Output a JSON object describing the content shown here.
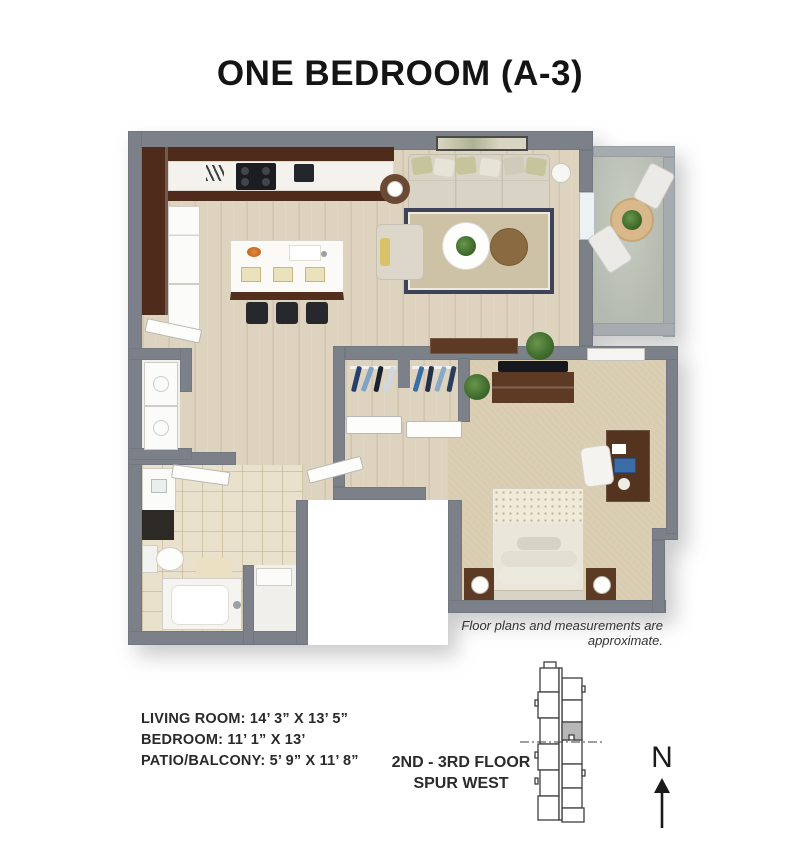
{
  "header": {
    "title": "ONE BEDROOM (A-3)"
  },
  "plan": {
    "disclaimer": "Floor plans and measurements are approximate.",
    "rooms": [
      "kitchen",
      "living room",
      "patio/balcony",
      "bedroom",
      "walk-in closet",
      "bathroom",
      "laundry",
      "hall"
    ]
  },
  "specs": {
    "lines": [
      "LIVING ROOM: 14’ 3” X 13’ 5”",
      "BEDROOM: 11’ 1” X 13’",
      "PATIO/BALCONY: 5’ 9” X 11’ 8”"
    ]
  },
  "location": {
    "line1": "2ND - 3RD FLOOR",
    "line2": "SPUR WEST"
  },
  "compass": {
    "label": "N"
  },
  "colors": {
    "wall": "#7b8089",
    "wood_floor": "#ded3bf",
    "carpet": "#d9ccb1",
    "tile": "#e9e1cb",
    "patio_concrete": "#b9beb4",
    "cabinet_dark_wood": "#4e2b1b",
    "furniture_wood": "#5d3a24",
    "rug_border": "#3d4358",
    "site_highlight": "#b7b7b7",
    "text": "#1c1c1c"
  }
}
